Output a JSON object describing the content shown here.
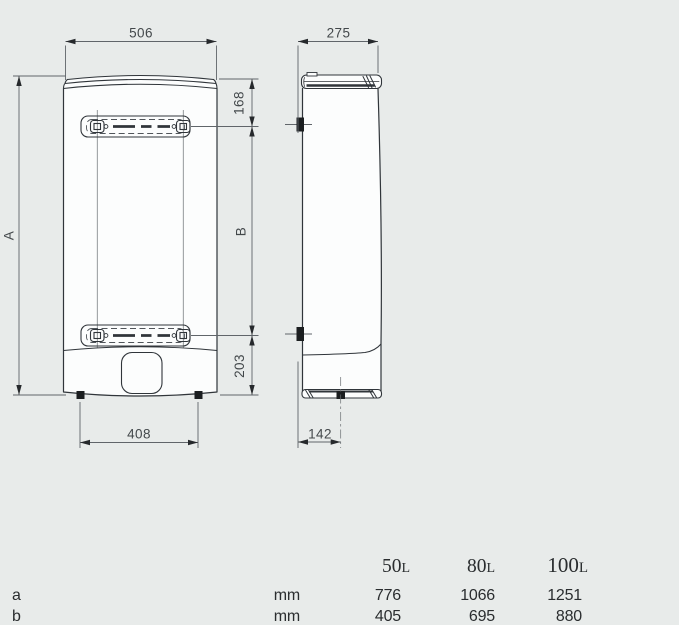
{
  "colors": {
    "background": "#e8ebea",
    "outline": "#30353a",
    "dimension_line": "#60656a",
    "dimension_text": "#43484b",
    "table_text": "#2a2d2f",
    "body_fill": "#fcfdfd"
  },
  "drawing": {
    "front_view": {
      "width_top": "506",
      "feet_spacing": "408",
      "total_height_label": "A",
      "top_to_bracket": "168",
      "bracket_spacing_label": "B",
      "bracket_to_bottom": "203"
    },
    "side_view": {
      "depth": "275",
      "wall_to_foot": "142"
    }
  },
  "table": {
    "col_headers": [
      {
        "num": "50",
        "unit": "L"
      },
      {
        "num": "80",
        "unit": "L"
      },
      {
        "num": "100",
        "unit": "L"
      }
    ],
    "rows": [
      {
        "label": "a",
        "unit": "mm",
        "values": [
          "776",
          "1066",
          "1251"
        ]
      },
      {
        "label": "b",
        "unit": "mm",
        "values": [
          "405",
          "695",
          "880"
        ]
      }
    ]
  }
}
